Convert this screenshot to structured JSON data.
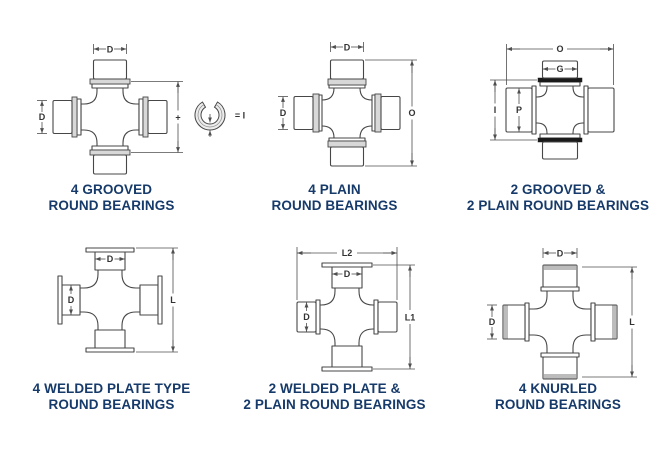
{
  "sheet": {
    "background": "#ffffff",
    "colors": {
      "caption_text": "#163a6a",
      "drawing_line": "#474747",
      "dimension_line": "#4f4f4f",
      "collar_fill": "#d8d8d8",
      "groove_ring_fill": "#1a1a1a",
      "snap_ring_fill": "#ececec"
    }
  },
  "diagrams": [
    {
      "name": "4-grooved-round-bearings",
      "caption": [
        "4 GROOVED",
        "ROUND BEARINGS"
      ],
      "labels": {
        "top_diameter": "D",
        "left_diameter": "D",
        "height_plus": "+",
        "snap_ring_equals": "= I"
      }
    },
    {
      "name": "4-plain-round-bearings",
      "caption": [
        "4 PLAIN",
        "ROUND BEARINGS"
      ],
      "labels": {
        "top_diameter": "D",
        "left_diameter": "D",
        "overall_height": "O"
      }
    },
    {
      "name": "2-grooved-2-plain-round-bearings",
      "caption": [
        "2 GROOVED &",
        "2 PLAIN ROUND BEARINGS"
      ],
      "labels": {
        "overall_width": "O",
        "groove_cap_width": "G",
        "groove_span": "I",
        "cup_diameter": "P"
      }
    },
    {
      "name": "4-welded-plate-type-round-bearings",
      "caption": [
        "4 WELDED PLATE TYPE",
        "ROUND BEARINGS"
      ],
      "labels": {
        "top_diameter": "D",
        "left_diameter": "D",
        "overall_length": "L"
      }
    },
    {
      "name": "2-welded-plate-2-plain-round-bearings",
      "caption": [
        "2 WELDED PLATE &",
        "2 PLAIN ROUND BEARINGS"
      ],
      "labels": {
        "overall_width": "L2",
        "top_diameter": "D",
        "left_diameter": "D",
        "overall_length": "L1"
      }
    },
    {
      "name": "4-knurled-round-bearings",
      "caption": [
        "4 KNURLED",
        "ROUND BEARINGS"
      ],
      "labels": {
        "top_diameter": "D",
        "left_diameter": "D",
        "overall_length": "L"
      }
    }
  ]
}
